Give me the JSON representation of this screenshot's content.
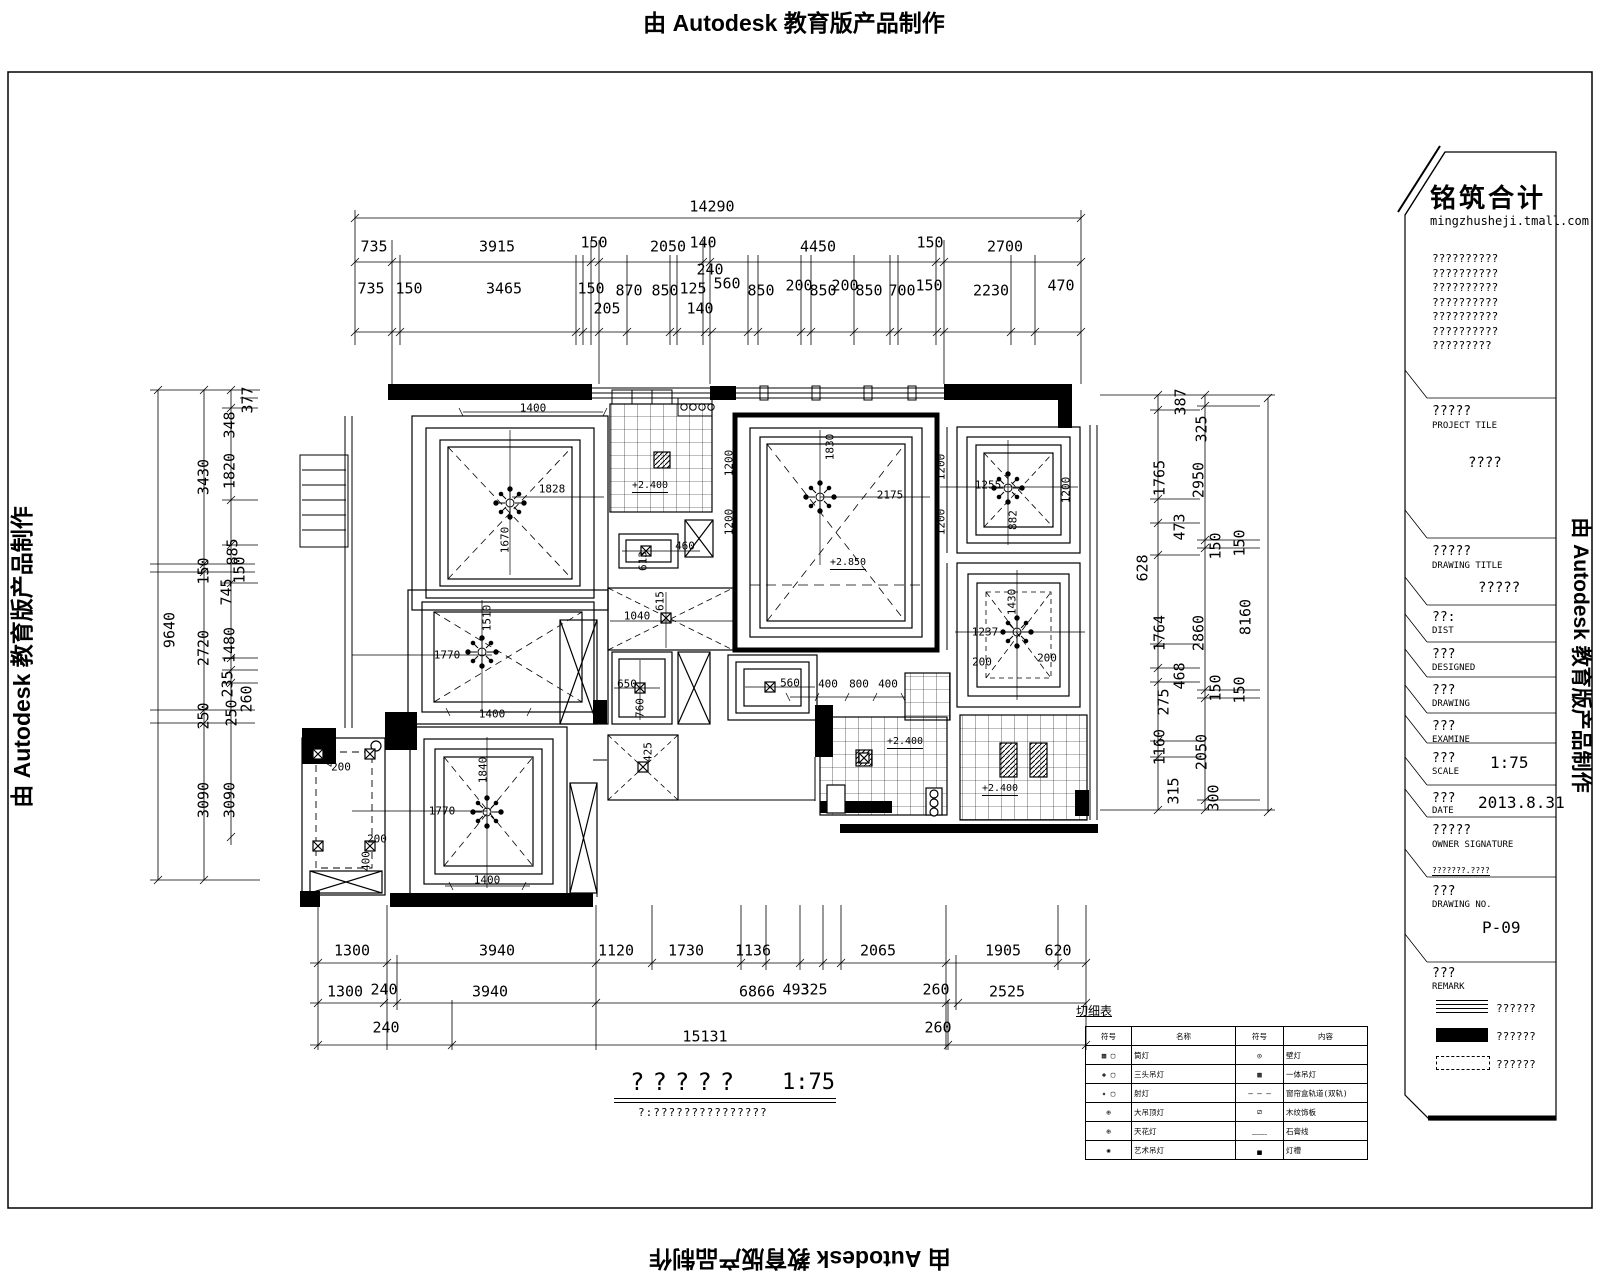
{
  "banner": {
    "text": "由 Autodesk 教育版产品制作"
  },
  "tb": {
    "logo": "铭筑合计",
    "site": "mingzhusheji.tmall.com",
    "notes": [
      "??????????",
      "??????????",
      "??????????",
      "??????????",
      "??????????",
      "??????????",
      "?????????"
    ],
    "project_label": "?????",
    "project_sub": "PROJECT TILE",
    "project_value": "????",
    "dtitle_label": "?????",
    "dtitle_sub": "DRAWING TITLE",
    "dtitle_value": "?????",
    "dist_label": "??:",
    "dist_sub": "DIST",
    "designed_label": "???",
    "designed_sub": "DESIGNED",
    "drawing_label": "???",
    "drawing_sub": "DRAWING",
    "examine_label": "???",
    "examine_sub": "EXAMINE",
    "scale_label": "???",
    "scale_sub": "SCALE",
    "scale_value": "1:75",
    "date_label": "???",
    "date_sub": "DATE",
    "date_value": "2013.8.31",
    "owner_label": "?????",
    "owner_sub": "OWNER SIGNATURE",
    "small_note": "???????.????",
    "no_label": "???",
    "no_sub": "DRAWING NO.",
    "no_value": "P-09",
    "remark_label": "???",
    "remark_sub": "REMARK",
    "legend": [
      {
        "type": "lines",
        "text": "??????"
      },
      {
        "type": "solid",
        "text": "??????"
      },
      {
        "type": "dashed",
        "text": "??????"
      }
    ]
  },
  "footer": {
    "title": "?????",
    "scale": "1:75",
    "note": "?:???????????????"
  },
  "legend_table": {
    "title": "切细表",
    "headers": [
      "符号",
      "名称",
      "符号",
      "内容"
    ],
    "rows": [
      [
        "▦ ▢",
        "筒灯",
        "◎",
        "壁灯"
      ],
      [
        "◈ ▢",
        "三头吊灯",
        "▩",
        "一体吊灯"
      ],
      [
        "✦ ▢",
        "射灯",
        "— — —",
        "窗帘盒轨道(双轨)"
      ],
      [
        "⊕",
        "大吊顶灯",
        "⧄",
        "木纹饰板"
      ],
      [
        "⊕",
        "天花灯",
        "﹏﹏",
        "石膏线"
      ],
      [
        "✺",
        "艺术吊灯",
        "▄",
        "灯槽"
      ]
    ]
  },
  "plan": {
    "labels": [
      [
        "14290",
        712,
        207,
        ""
      ],
      [
        "735",
        374,
        247,
        ""
      ],
      [
        "3915",
        497,
        247,
        ""
      ],
      [
        "150",
        594,
        243,
        ""
      ],
      [
        "2050",
        668,
        247,
        ""
      ],
      [
        "140",
        703,
        243,
        ""
      ],
      [
        "4450",
        818,
        247,
        ""
      ],
      [
        "150",
        930,
        243,
        ""
      ],
      [
        "2700",
        1005,
        247,
        ""
      ],
      [
        "735",
        371,
        289,
        ""
      ],
      [
        "150",
        409,
        289,
        ""
      ],
      [
        "3465",
        504,
        289,
        ""
      ],
      [
        "150",
        591,
        289,
        ""
      ],
      [
        "870",
        629,
        291,
        ""
      ],
      [
        "850",
        665,
        291,
        ""
      ],
      [
        "125",
        693,
        289,
        ""
      ],
      [
        "560",
        727,
        284,
        ""
      ],
      [
        "850",
        761,
        291,
        ""
      ],
      [
        "200",
        799,
        286,
        ""
      ],
      [
        "850",
        823,
        291,
        ""
      ],
      [
        "200",
        845,
        286,
        ""
      ],
      [
        "850",
        869,
        291,
        ""
      ],
      [
        "700",
        902,
        291,
        ""
      ],
      [
        "150",
        929,
        286,
        ""
      ],
      [
        "2230",
        991,
        291,
        ""
      ],
      [
        "470",
        1061,
        286,
        ""
      ],
      [
        "240",
        710,
        270,
        ""
      ],
      [
        "205",
        607,
        309,
        ""
      ],
      [
        "140",
        700,
        309,
        ""
      ],
      [
        "9640",
        170,
        630,
        "v"
      ],
      [
        "3430",
        204,
        477,
        "v"
      ],
      [
        "150",
        204,
        571,
        "v"
      ],
      [
        "2720",
        204,
        648,
        "v"
      ],
      [
        "250",
        204,
        716,
        "v"
      ],
      [
        "3090",
        204,
        800,
        "v"
      ],
      [
        "377",
        248,
        400,
        "v"
      ],
      [
        "348",
        230,
        425,
        "v"
      ],
      [
        "1820",
        230,
        471,
        "v"
      ],
      [
        "885",
        233,
        552,
        "v"
      ],
      [
        "745",
        227,
        592,
        "v"
      ],
      [
        "150",
        240,
        570,
        "v"
      ],
      [
        "1480",
        230,
        645,
        "v"
      ],
      [
        "235",
        228,
        684,
        "v"
      ],
      [
        "260",
        247,
        699,
        "v"
      ],
      [
        "250",
        232,
        713,
        "v"
      ],
      [
        "3090",
        230,
        800,
        "v"
      ],
      [
        "387",
        1181,
        402,
        "v"
      ],
      [
        "1765",
        1160,
        478,
        "v"
      ],
      [
        "473",
        1180,
        527,
        "v"
      ],
      [
        "628",
        1143,
        568,
        "v"
      ],
      [
        "1764",
        1160,
        633,
        "v"
      ],
      [
        "468",
        1180,
        676,
        "v"
      ],
      [
        "275",
        1164,
        702,
        "v"
      ],
      [
        "1160",
        1160,
        747,
        "v"
      ],
      [
        "315",
        1174,
        791,
        "v"
      ],
      [
        "325",
        1202,
        429,
        "v"
      ],
      [
        "2950",
        1199,
        480,
        "v"
      ],
      [
        "150",
        1216,
        546,
        "v"
      ],
      [
        "2860",
        1199,
        633,
        "v"
      ],
      [
        "150",
        1216,
        688,
        "v"
      ],
      [
        "2050",
        1202,
        752,
        "v"
      ],
      [
        "300",
        1214,
        798,
        "v"
      ],
      [
        "150",
        1240,
        543,
        "v"
      ],
      [
        "8160",
        1246,
        617,
        "v"
      ],
      [
        "150",
        1240,
        690,
        "v"
      ],
      [
        "1300",
        352,
        951,
        ""
      ],
      [
        "3940",
        497,
        951,
        ""
      ],
      [
        "1120",
        616,
        951,
        ""
      ],
      [
        "1730",
        686,
        951,
        ""
      ],
      [
        "1136",
        753,
        951,
        ""
      ],
      [
        "2065",
        878,
        951,
        ""
      ],
      [
        "1905",
        1003,
        951,
        ""
      ],
      [
        "620",
        1058,
        951,
        ""
      ],
      [
        "1300",
        345,
        992,
        ""
      ],
      [
        "240",
        384,
        990,
        ""
      ],
      [
        "3940",
        490,
        992,
        ""
      ],
      [
        "6866",
        757,
        992,
        ""
      ],
      [
        "493",
        796,
        990,
        ""
      ],
      [
        "325",
        814,
        990,
        ""
      ],
      [
        "260",
        936,
        990,
        ""
      ],
      [
        "2525",
        1007,
        992,
        ""
      ],
      [
        "240",
        386,
        1028,
        ""
      ],
      [
        "15131",
        705,
        1037,
        ""
      ],
      [
        "260",
        938,
        1028,
        ""
      ],
      [
        "1400",
        533,
        408,
        "p"
      ],
      [
        "1828",
        552,
        489,
        "p"
      ],
      [
        "1670",
        505,
        540,
        "pv"
      ],
      [
        "1400",
        492,
        714,
        "p"
      ],
      [
        "1770",
        447,
        655,
        "p"
      ],
      [
        "1510",
        487,
        618,
        "pv"
      ],
      [
        "460",
        685,
        546,
        "p"
      ],
      [
        "613",
        643,
        561,
        "pv"
      ],
      [
        "1040",
        637,
        616,
        "p"
      ],
      [
        "615",
        660,
        601,
        "pv"
      ],
      [
        "650",
        627,
        684,
        "p"
      ],
      [
        "760",
        640,
        708,
        "pv"
      ],
      [
        "1830",
        830,
        447,
        "pv"
      ],
      [
        "2175",
        890,
        495,
        "p"
      ],
      [
        "1200",
        729,
        463,
        "pv"
      ],
      [
        "1200",
        729,
        522,
        "pv"
      ],
      [
        "1200",
        941,
        467,
        "pv"
      ],
      [
        "1200",
        941,
        522,
        "pv"
      ],
      [
        "1255",
        988,
        485,
        "p"
      ],
      [
        "1200",
        1066,
        490,
        "pv"
      ],
      [
        "882",
        1013,
        520,
        "pv"
      ],
      [
        "1430",
        1012,
        602,
        "pv"
      ],
      [
        "1237",
        985,
        632,
        "p"
      ],
      [
        "200",
        982,
        662,
        "p"
      ],
      [
        "200",
        1047,
        658,
        "p"
      ],
      [
        "560",
        790,
        683,
        "p"
      ],
      [
        "400",
        828,
        684,
        "p"
      ],
      [
        "800",
        859,
        684,
        "p"
      ],
      [
        "400",
        888,
        684,
        "p"
      ],
      [
        "1840",
        483,
        770,
        "pv"
      ],
      [
        "1770",
        442,
        811,
        "p"
      ],
      [
        "1400",
        487,
        880,
        "p"
      ],
      [
        "400",
        330,
        757,
        "pv"
      ],
      [
        "200",
        341,
        767,
        "p"
      ],
      [
        "200",
        377,
        839,
        "p"
      ],
      [
        "400",
        366,
        861,
        "pv"
      ],
      [
        "425",
        648,
        752,
        "pv"
      ],
      [
        "+2.400",
        650,
        487,
        "e"
      ],
      [
        "+2.850",
        848,
        564,
        "e"
      ],
      [
        "+2.400",
        905,
        743,
        "e"
      ],
      [
        "+2.400",
        1000,
        790,
        "e"
      ]
    ]
  }
}
